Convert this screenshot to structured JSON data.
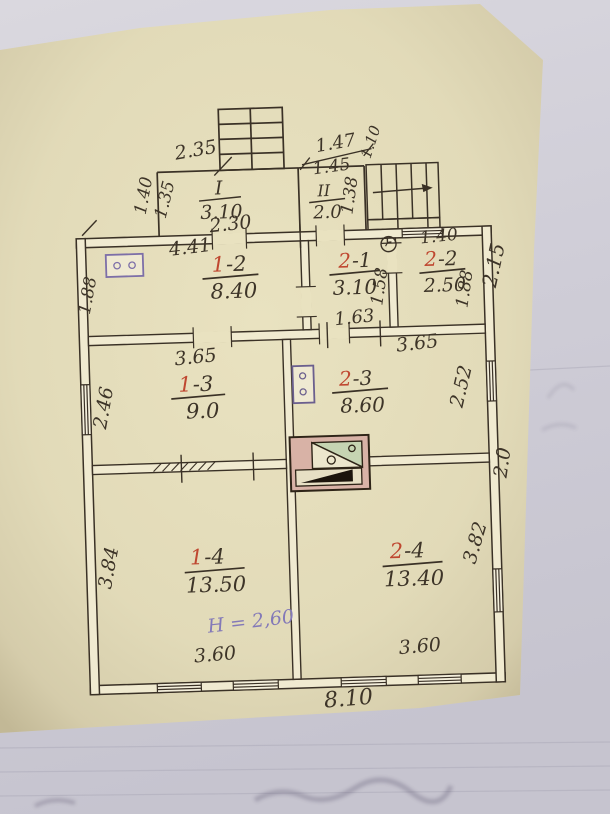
{
  "document": {
    "kind": "scanned floor plan (technical passport sheet)",
    "note": {
      "height": "H = 2,60"
    }
  },
  "palette": {
    "photo_bg": "#d3d1da",
    "sheet": "#e9e2c0",
    "wall_fill": "#f0ead0",
    "ink": "#3a3126",
    "red_ink": "#bf4730",
    "purple_ink": "#7d6fa8"
  },
  "porch": {
    "label": "I",
    "area": "3.10",
    "dim_top": "2.35",
    "dim_bottom": "2.30",
    "dim_left_outer": "1.40",
    "dim_left_inner": "1.35"
  },
  "vestibule": {
    "label": "II",
    "area": "2.0",
    "dim_top": "1.47",
    "dim_inner": "1.45",
    "dim_right": "1.38",
    "dim_stairs": "1.10"
  },
  "rooms": [
    {
      "id": "1-2",
      "red": "1",
      "black": "-2",
      "area": "8.40",
      "dim_top": "4.41",
      "dim_left": "1.88"
    },
    {
      "id": "2-1",
      "red": "2",
      "black": "-1",
      "area": "3.10",
      "dim_right": "1.58",
      "dim_bottom": "1.63"
    },
    {
      "id": "2-2",
      "red": "2",
      "black": "-2",
      "area": "2.50",
      "dim_top": "1.40",
      "dim_right": "1.88"
    },
    {
      "id": "1-3",
      "red": "1",
      "black": "-3",
      "area": "9.0",
      "dim_top": "3.65",
      "dim_left": "2.46"
    },
    {
      "id": "2-3",
      "red": "2",
      "black": "-3",
      "area": "8.60",
      "dim_top": "3.65",
      "dim_right": "2.52"
    },
    {
      "id": "1-4",
      "red": "1",
      "black": "-4",
      "area": "13.50",
      "dim_left": "3.84",
      "dim_bottom": "3.60"
    },
    {
      "id": "2-4",
      "red": "2",
      "black": "-4",
      "area": "13.40",
      "dim_right": "3.82",
      "dim_bottom": "3.60"
    }
  ],
  "exterior": {
    "dim_bottom": "8.10",
    "dim_right_top": "2.15",
    "dim_right_mid": "2.0"
  },
  "symbols": {
    "stairs_top": "entrance stairs",
    "stairs_right": "side stairs",
    "electric_stove": "stove symbol in room 1-2",
    "gas_stove": "stove symbol in room 2-3",
    "meter": "round meter in room 2-1",
    "furnace": "masonry furnace between rooms",
    "hatched_wall": "hatched partition segment"
  }
}
